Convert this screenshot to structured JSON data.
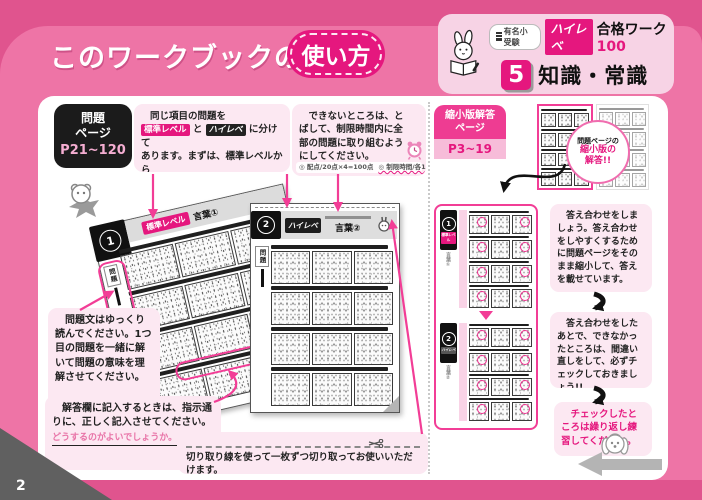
{
  "header": {
    "title_prefix": "このワークブックの",
    "title_highlight": "使い方"
  },
  "brand": {
    "series_badge": "有名小受験",
    "logo": "ハイレベ",
    "series_name": "合格ワーク",
    "series_number": "100",
    "volume_number": "5",
    "volume_title": "知識・常識"
  },
  "problem_section": {
    "badge_line1": "問題",
    "badge_line2": "ページ",
    "badge_range": "P21~120",
    "bubble_levels": {
      "line1": "同じ項目の問題を",
      "badge_standard": "標準レベル",
      "conj": "と",
      "badge_high": "ハイレベ",
      "line1_end": "に分けて",
      "line2": "あります。まずは、標準レベルから",
      "line3": "解いてください。100点満点です。"
    },
    "bubble_time": {
      "text": "　できないところは、とばして、制限時間内に全部の問題に取り組むようにしてください。",
      "note_points": "◎ 配点/20点×4=100点",
      "note_time": "◎ 制限時間/各10分"
    },
    "bubble_read_slow": "　問題文はゆっくり読んでください。1つ目の問題を一緒に解いて問題の意味を理解させてください。",
    "bubble_answer_box": {
      "text": "　解答欄に記入するときは、指示通りに、正しく記入させてください。",
      "sample": "どうするのがよいでしょうか。"
    },
    "bubble_cutline": "切り取り線を使って一枚ずつ切り取ってお使いいただけます。"
  },
  "workbook_pages": {
    "back_page": {
      "tab_number": "1",
      "level_badge": "標準レベル",
      "title": "言葉①",
      "side_tab": "問題"
    },
    "front_page": {
      "tab_number": "2",
      "level_badge": "ハイレベ",
      "title": "言葉②",
      "side_tab": "問題"
    }
  },
  "answer_section": {
    "badge_line1": "縮小版解答",
    "badge_line2": "ページ",
    "badge_range": "P3~19",
    "zoom_note_line1": "問題ページの",
    "zoom_note_line2": "縮小版の",
    "zoom_note_line3": "解答!!",
    "mini_pages": [
      {
        "tab_number": "1",
        "level": "標準レベル",
        "title": "言葉①"
      },
      {
        "tab_number": "2",
        "level": "ハイレベ",
        "title": "言葉②"
      }
    ],
    "bubble_check": "　答え合わせをしましょう。答え合わせをしやすくするために問題ページをそのまま縮小して、答えを載せています。",
    "bubble_redo": "　答え合わせをしたあとで、できなかったところは、間違い直しをして、必ずチェックしておきましょう!!",
    "bubble_repeat": "　チェックしたところは繰り返し練習してください。"
  },
  "footer": {
    "page_number": "2"
  },
  "colors": {
    "background": "#ee74a6",
    "accent": "#e5177e",
    "bubble": "#fce8f2"
  }
}
